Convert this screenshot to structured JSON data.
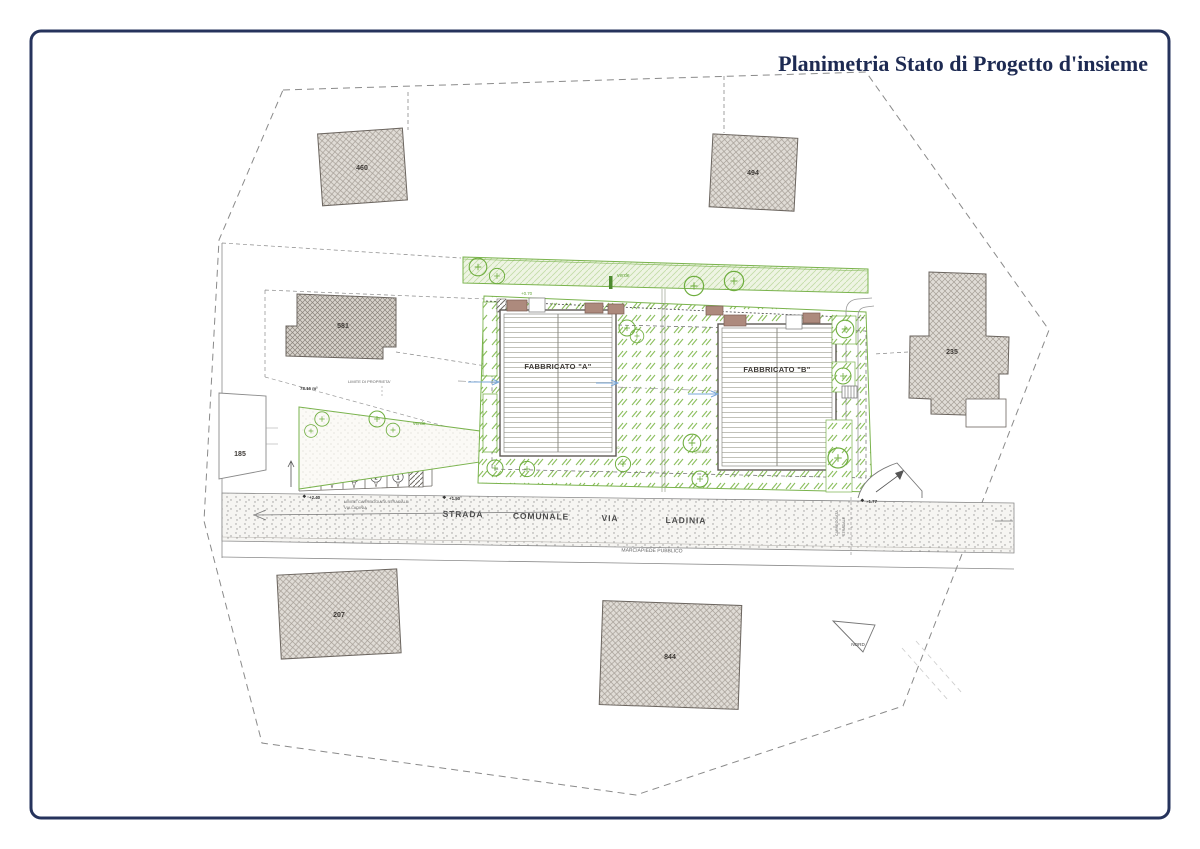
{
  "page": {
    "title": "Planimetria Stato di Progetto d'insieme"
  },
  "colors": {
    "frame": "#26335c",
    "title_text": "#1d2a52",
    "green": "#6fae3f",
    "building_fill": "#dcd8d3",
    "terrace": "#ad8a7d",
    "blue_arrow": "#7aa7d8"
  },
  "buildings": {
    "b460": "460",
    "b494": "494",
    "b581": "581",
    "b235": "235",
    "b185": "185",
    "b207": "207",
    "b844": "844"
  },
  "fabbricati": {
    "a": "FABBRICATO \"A\"",
    "b": "FABBRICATO \"B\""
  },
  "road": {
    "words": [
      "STRADA",
      "COMUNALE",
      "VIA",
      "LADINIA"
    ],
    "sidewalk_label": "MARCIAPIEDE PUBBLICO",
    "carriageway_v1": "CARREGGIATA",
    "carriageway_v2": "STRADALE",
    "limit_small_1": "LIMITE CARREGGIATA STRADALE",
    "limit_small_2": "VIA LADINIA"
  },
  "green": {
    "verde_top": "verde",
    "verde_left": "verde",
    "giardino": [
      "giardino",
      "giardino",
      "giardino",
      "giardino"
    ],
    "interrato": "PARTE VOLUME INTERRATO"
  },
  "annotations": {
    "property_limit": "LIMITE DI PROPRIETA'",
    "area": "78.16 m²",
    "lvl_240": "+2.40",
    "lvl_150": "+1.50",
    "lvl_070": "+0.70",
    "lvl_177": "-1.77",
    "north": "NORD"
  },
  "parking": {
    "stalls": [
      "5",
      "4",
      "3",
      "2",
      "1"
    ]
  }
}
